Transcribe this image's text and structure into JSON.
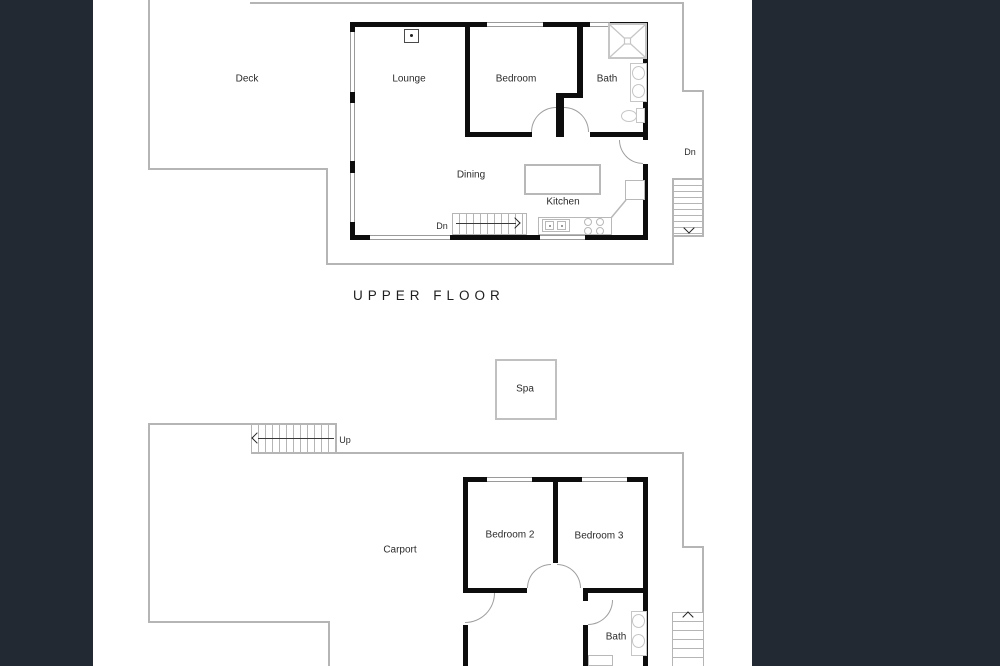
{
  "colors": {
    "background": "#232932",
    "paper": "#ffffff",
    "walls": "#0d0d0d",
    "outlines": "#b5b5b5"
  },
  "upper_floor": {
    "title": "UPPER FLOOR",
    "rooms": [
      {
        "label": "Deck"
      },
      {
        "label": "Lounge"
      },
      {
        "label": "Bedroom"
      },
      {
        "label": "Bath"
      },
      {
        "label": "Dining"
      },
      {
        "label": "Kitchen"
      }
    ],
    "stairs": {
      "internal_label": "Dn",
      "external_label": "Dn"
    }
  },
  "lower_floor": {
    "rooms": [
      {
        "label": "Spa"
      },
      {
        "label": "Carport"
      },
      {
        "label": "Bedroom 2"
      },
      {
        "label": "Bedroom 3"
      },
      {
        "label": "Bath"
      }
    ],
    "stairs": {
      "up_label": "Up"
    }
  }
}
